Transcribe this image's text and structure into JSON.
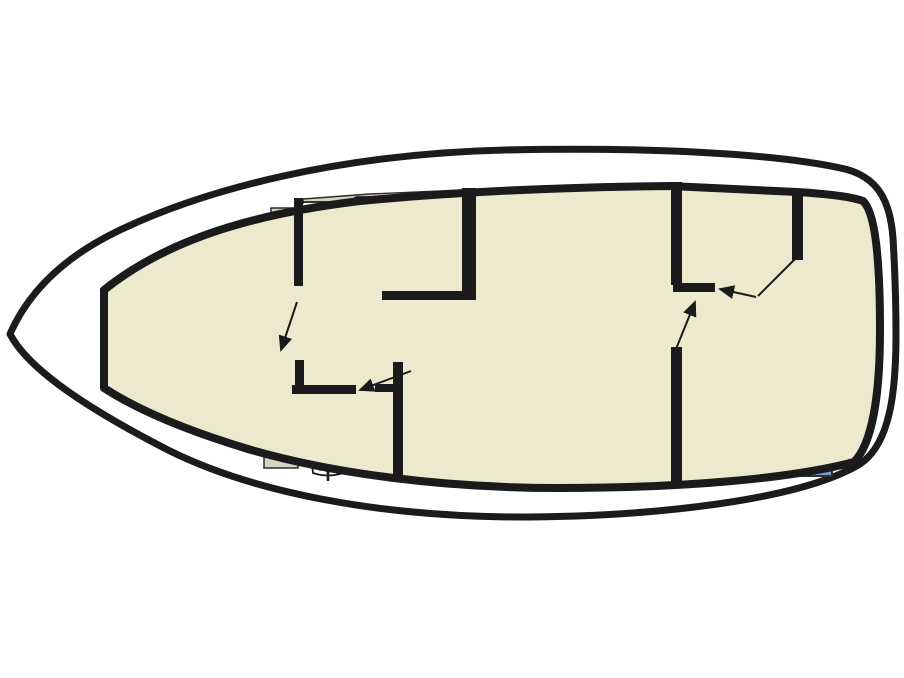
{
  "diagram": {
    "type": "boat-floorplan",
    "orientation": "bow-left-stern-right",
    "areas": [
      {
        "id": "v-berth-cabin",
        "desc": "forward V-berth cabin with two cushions and center walkway"
      },
      {
        "id": "galley",
        "desc": "galley with 4-burner stove, sink with drainer and refrigerator"
      },
      {
        "id": "saloon",
        "desc": "saloon with L-shaped berth, cushion and table"
      },
      {
        "id": "forward-bathroom",
        "desc": "bathroom with toilet, shower tray and washbasin"
      },
      {
        "id": "single-berth",
        "desc": "single berth with cushion and side bolster"
      },
      {
        "id": "aft-bathroom",
        "desc": "aft bathroom with toilet, shower tray and washbasin"
      },
      {
        "id": "aft-cabin",
        "desc": "aft cabin with double berth, two pillows and counter"
      }
    ],
    "fixtures": [
      "stove",
      "sink",
      "refrigerator",
      "toilet",
      "shower",
      "washbasin",
      "table",
      "steps",
      "ladder",
      "wardrobe"
    ]
  },
  "colors": {
    "line": "#1b1b1b",
    "outline": "#2b2b2b",
    "floor": "#EDE9CF",
    "counter": "#D7D4C1",
    "shelf": "#E5E1C5",
    "berth_orange": "#E6993F",
    "pillow_orange": "#F0B266",
    "berth_teal": "#8CC7B1",
    "pillow_teal": "#C9E5D9",
    "berth_blue": "#7E99C8",
    "pillow_blue": "#ADC0DF",
    "berth_pink": "#ECCFD6",
    "steps_gray": "#BDBBB1",
    "white": "#FFFFFF"
  }
}
